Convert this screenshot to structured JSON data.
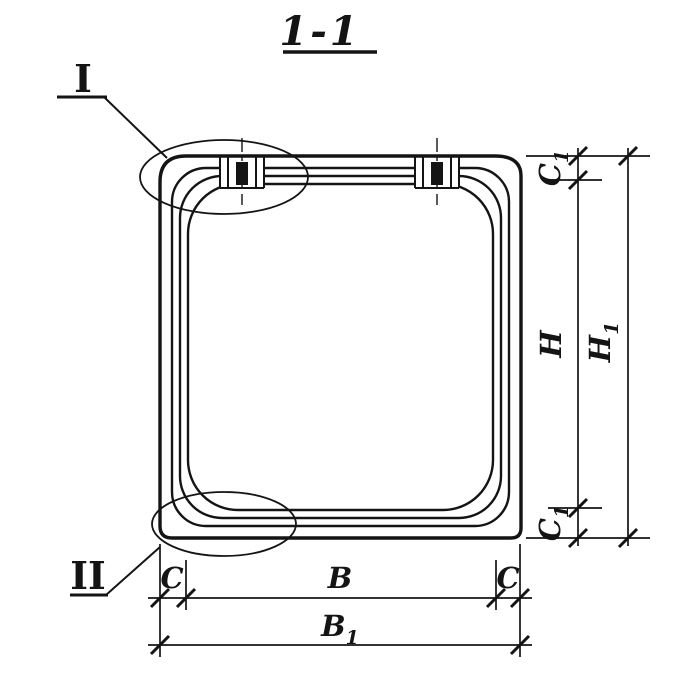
{
  "title": "1-1",
  "callouts": {
    "top_left": "I",
    "bottom_left": "II"
  },
  "dimensions": {
    "c1_top": {
      "main": "C",
      "sub": "1"
    },
    "h": "H",
    "h1": {
      "main": "H",
      "sub": "1"
    },
    "c1_bottom": {
      "main": "C",
      "sub": "1"
    },
    "c_left": "C",
    "b": "B",
    "c_right": "C",
    "b1": {
      "main": "B",
      "sub": "1"
    }
  },
  "colors": {
    "ink": "#141414",
    "paper": "#ffffff"
  }
}
